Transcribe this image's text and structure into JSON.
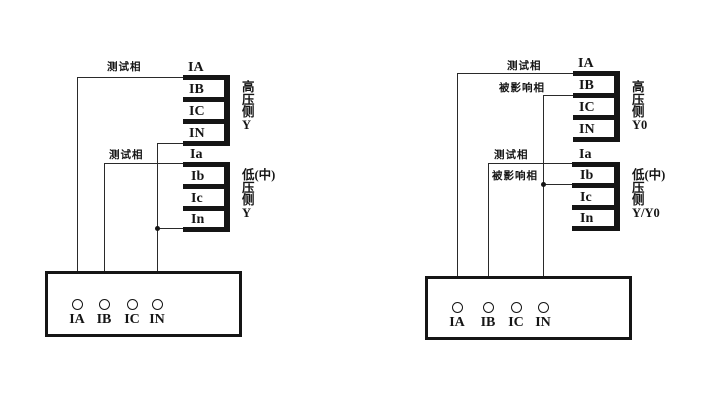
{
  "colors": {
    "ink": "#151515",
    "background": "#ffffff"
  },
  "left_diagram": {
    "high_side": {
      "terminals": [
        "IA",
        "IB",
        "IC",
        "IN"
      ],
      "winding_label_lines": [
        "高",
        "压",
        "侧",
        "Y"
      ]
    },
    "low_side": {
      "terminals": [
        "Ia",
        "Ib",
        "Ic",
        "In"
      ],
      "winding_label_lines": [
        "低(中)",
        "压",
        "侧",
        "Y"
      ]
    },
    "annotations": {
      "high_test_phase": "测试相",
      "low_test_phase": "测试相"
    },
    "tester_box": {
      "terminals": [
        "IA",
        "IB",
        "IC",
        "IN"
      ]
    }
  },
  "right_diagram": {
    "high_side": {
      "terminals": [
        "IA",
        "IB",
        "IC",
        "IN"
      ],
      "winding_label_lines": [
        "高",
        "压",
        "侧",
        "Y0"
      ]
    },
    "low_side": {
      "terminals": [
        "Ia",
        "Ib",
        "Ic",
        "In"
      ],
      "winding_label_lines": [
        "低(中)",
        "压",
        "侧",
        "Y/Y0"
      ]
    },
    "annotations": {
      "high_test_phase": "测试相",
      "high_affected_phase": "被影响相",
      "low_test_phase": "测试相",
      "low_affected_phase": "被影响相"
    },
    "tester_box": {
      "terminals": [
        "IA",
        "IB",
        "IC",
        "IN"
      ]
    }
  }
}
